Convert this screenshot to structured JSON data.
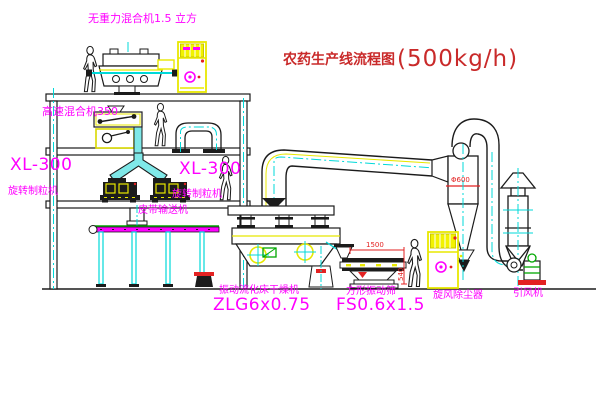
{
  "diagram": {
    "title_zh": "农药生产线流程图",
    "title_capacity": "(500kg/h)"
  },
  "labels": {
    "gravity_mixer": "无重力混合机1.5 立方",
    "high_speed_mixer": "高速混合机350",
    "granulator_left": {
      "model": "XL-300",
      "name": "旋转制粒机"
    },
    "granulator_right": {
      "model": "XL-300",
      "name": "旋转制粒机"
    },
    "belt_conveyor": "皮带输送机",
    "dryer": {
      "name": "振动流化床干燥机",
      "model": "ZLG6x0.75"
    },
    "sieve": {
      "name": "方形振动筛",
      "model": "FS0.6x1.5"
    },
    "cyclone": "旋风除尘器",
    "fan": "引风机"
  },
  "dimensions": {
    "cyclone_diameter": "Φ600",
    "sieve_length": "1500",
    "sieve_height": "540"
  },
  "colors": {
    "label_magenta": "#ff00ff",
    "title_red": "#c92a2a",
    "dimension_red": "#e32222",
    "line_black": "#1b1b1b",
    "cad_yellow": "#e8e800",
    "centerline_cyan": "#00d9d9",
    "accent_green": "#00a800",
    "base_red": "#e32222"
  }
}
